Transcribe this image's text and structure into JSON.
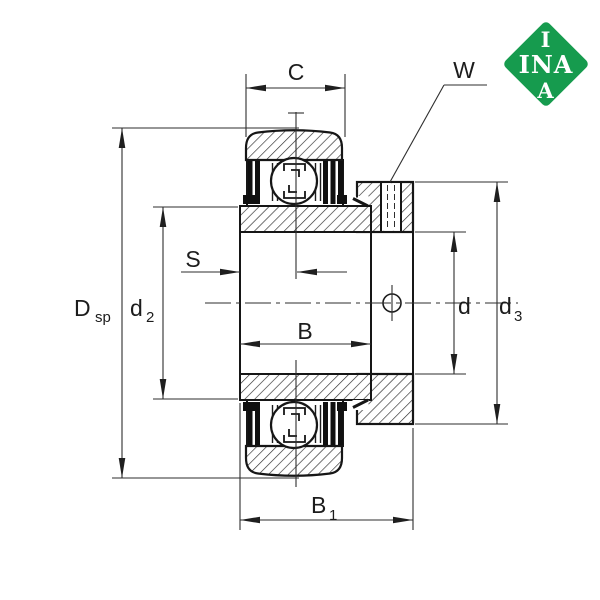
{
  "colors": {
    "background": "#ffffff",
    "line": "#1b1b1b",
    "dim_line": "#2e2e2e",
    "logo_green": "#169b4e",
    "logo_text": "#ffffff"
  },
  "logo": {
    "line1": "I",
    "line2": "INA",
    "line3": "A"
  },
  "labels": {
    "C": {
      "main": "C",
      "sub": ""
    },
    "W": {
      "main": "W",
      "sub": ""
    },
    "S": {
      "main": "S",
      "sub": ""
    },
    "B": {
      "main": "B",
      "sub": ""
    },
    "B1": {
      "main": "B",
      "sub": "1"
    },
    "Dsp": {
      "main": "D",
      "sub": "sp"
    },
    "d2": {
      "main": "d",
      "sub": "2"
    },
    "d": {
      "main": "d",
      "sub": ""
    },
    "d3": {
      "main": "d",
      "sub": "3"
    }
  }
}
